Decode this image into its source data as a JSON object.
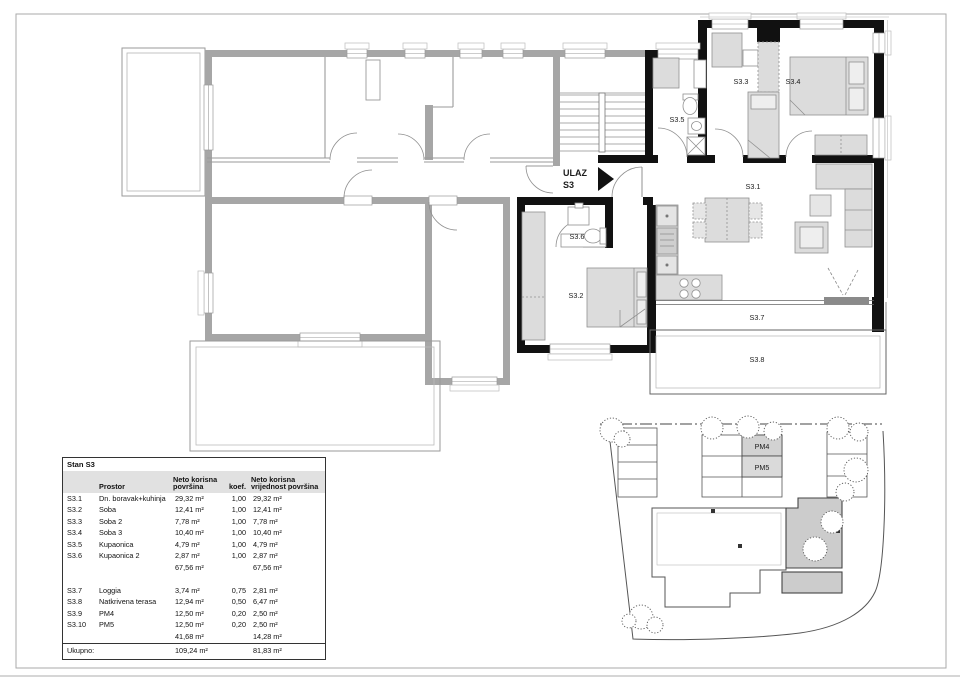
{
  "plan": {
    "entrance": {
      "line1": "ULAZ",
      "line2": "S3"
    },
    "rooms": {
      "s31": "S3.1",
      "s32": "S3.2",
      "s33": "S3.3",
      "s34": "S3.4",
      "s35": "S3.5",
      "s36": "S3.6",
      "s37": "S3.7",
      "s38": "S3.8"
    }
  },
  "site": {
    "pm4": "PM4",
    "pm5": "PM5"
  },
  "colors": {
    "wall": "#111111",
    "neighbor_wall": "#a6a6a6",
    "highlight_fill": "#cccccc",
    "furniture": "#dcdcdc"
  },
  "table": {
    "title": "Stan S3",
    "headers": {
      "prostor": "Prostor",
      "neto1a": "Neto korisna",
      "neto1b": "površina",
      "koef": "koef.",
      "neto2a": "Neto korisna",
      "neto2b": "vrijednost površina"
    },
    "rows": [
      {
        "id": "S3.1",
        "name": "Dn. boravak+kuhinja",
        "area": "29,32 m²",
        "koef": "1,00",
        "value": "29,32 m²"
      },
      {
        "id": "S3.2",
        "name": "Soba",
        "area": "12,41 m²",
        "koef": "1,00",
        "value": "12,41 m²"
      },
      {
        "id": "S3.3",
        "name": "Soba 2",
        "area": "7,78 m²",
        "koef": "1,00",
        "value": "7,78 m²"
      },
      {
        "id": "S3.4",
        "name": "Soba 3",
        "area": "10,40 m²",
        "koef": "1,00",
        "value": "10,40 m²"
      },
      {
        "id": "S3.5",
        "name": "Kupaonica",
        "area": "4,79 m²",
        "koef": "1,00",
        "value": "4,79 m²"
      },
      {
        "id": "S3.6",
        "name": "Kupaonica 2",
        "area": "2,87 m²",
        "koef": "1,00",
        "value": "2,87 m²"
      },
      {
        "id": "",
        "name": "",
        "area": "67,56 m²",
        "koef": "",
        "value": "67,56 m²"
      },
      {
        "id": "",
        "name": "",
        "area": "",
        "koef": "",
        "value": ""
      },
      {
        "id": "S3.7",
        "name": "Loggia",
        "area": "3,74 m²",
        "koef": "0,75",
        "value": "2,81 m²"
      },
      {
        "id": "S3.8",
        "name": "Natkrivena terasa",
        "area": "12,94 m²",
        "koef": "0,50",
        "value": "6,47 m²"
      },
      {
        "id": "S3.9",
        "name": "PM4",
        "area": "12,50 m²",
        "koef": "0,20",
        "value": "2,50 m²"
      },
      {
        "id": "S3.10",
        "name": "PM5",
        "area": "12,50 m²",
        "koef": "0,20",
        "value": "2,50 m²"
      },
      {
        "id": "",
        "name": "",
        "area": "41,68 m²",
        "koef": "",
        "value": "14,28 m²"
      }
    ],
    "total": {
      "label": "Ukupno:",
      "area": "109,24 m²",
      "value": "81,83 m²"
    }
  }
}
